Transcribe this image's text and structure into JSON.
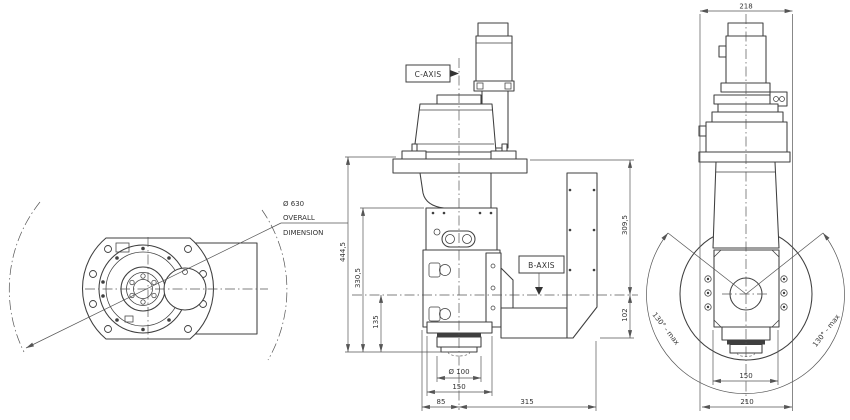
{
  "drawing": {
    "colors": {
      "background": "#ffffff",
      "part_lines": "#3f3f3f",
      "dim_lines": "#555555",
      "text": "#333333"
    },
    "rear_view": {
      "overall_label": {
        "line1": "Ø 630",
        "line2": "OVERALL",
        "line3": "DIMENSION"
      }
    },
    "front_view": {
      "c_axis_label": "C-AXIS",
      "b_axis_label": "B-AXIS",
      "dim_total_height": "444,5",
      "dim_head_height": "330,5",
      "dim_baxis_to_face": "135",
      "dim_flange_to_baxis": "309,5",
      "dim_baxis_to_bottom": "102",
      "dim_spindle_diameter": "Ø 100",
      "dim_nose_width": "150",
      "dim_left_span": "85",
      "dim_right_span": "315"
    },
    "side_view": {
      "dim_top_width": "218",
      "dim_nose_width": "150",
      "dim_body_width": "210",
      "swing_left_label": "130° - max",
      "swing_right_label": "130° - max"
    }
  }
}
